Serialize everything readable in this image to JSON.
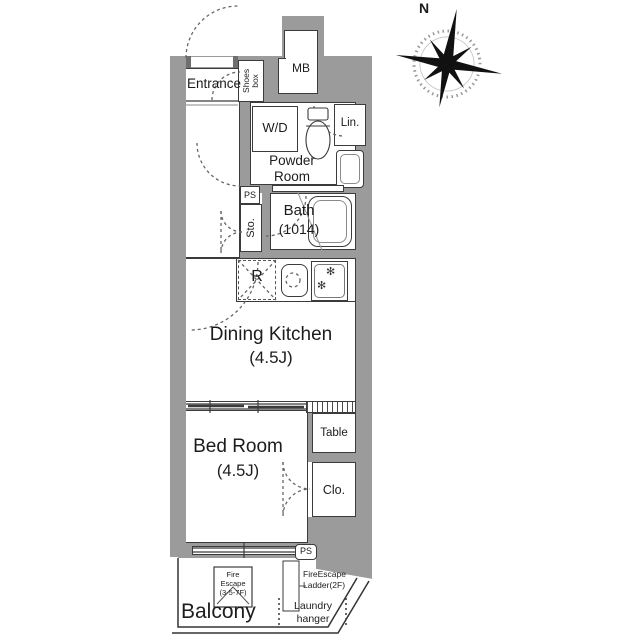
{
  "plan": {
    "rooms": {
      "entrance": "Entrance",
      "shoes_box_line1": "Shoes",
      "shoes_box_line2": "box",
      "mb": "MB",
      "wd": "W/D",
      "powder_line1": "Powder",
      "powder_line2": "Room",
      "linen": "Lin.",
      "ps_top": "PS",
      "storage": "Sto.",
      "bath": "Bath",
      "bath_size": "(1014)",
      "refrigerator": "R",
      "dining_kitchen": "Dining Kitchen",
      "dining_kitchen_size": "(4.5J)",
      "bed_room": "Bed Room",
      "bed_room_size": "(4.5J)",
      "table": "Table",
      "closet": "Clo.",
      "ps_bottom": "PS",
      "balcony": "Balcony"
    },
    "annotations": {
      "fire_escape_line1": "Fire",
      "fire_escape_line2": "Escape",
      "fire_escape_line3": "(3-5-7F)",
      "ladder_line1": "FireEscape",
      "ladder_line2": "Ladder(2F)",
      "laundry_line1": "Laundry",
      "laundry_line2": "hanger"
    },
    "compass": {
      "north": "N"
    },
    "colors": {
      "wall": "#9b9b9b",
      "outline": "#3b3b3b",
      "background": "#ffffff"
    }
  }
}
